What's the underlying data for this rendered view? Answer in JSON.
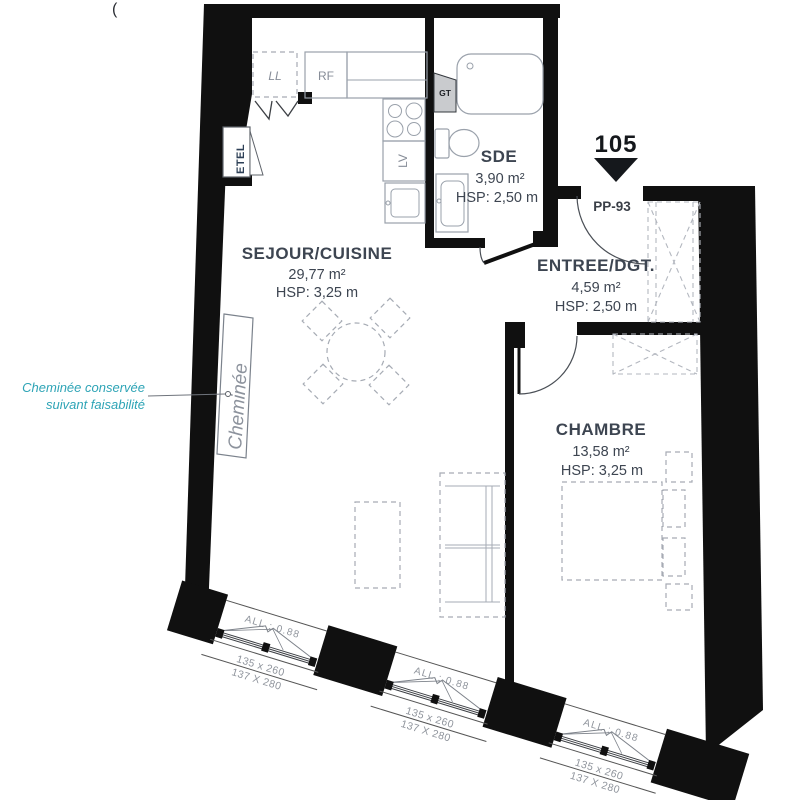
{
  "meta": {
    "stray_mark": "("
  },
  "unit": {
    "number": "105",
    "entry_door_label": "PP-93"
  },
  "rooms": {
    "sejour": {
      "name": "SEJOUR/CUISINE",
      "area": "29,77 m²",
      "hsp": "HSP: 3,25 m"
    },
    "sde": {
      "name": "SDE",
      "area": "3,90 m²",
      "hsp": "HSP: 2,50 m"
    },
    "entree": {
      "name": "ENTREE/DGT.",
      "area": "4,59 m²",
      "hsp": "HSP: 2,50 m"
    },
    "chambre": {
      "name": "CHAMBRE",
      "area": "13,58 m²",
      "hsp": "HSP: 3,25 m"
    }
  },
  "fixtures": {
    "ll": "LL",
    "rf": "RF",
    "lv": "LV",
    "gt": "GT",
    "etel": "ETEL"
  },
  "fireplace": {
    "label": "Cheminée",
    "note_line1": "Cheminée conservée",
    "note_line2": "suivant faisabilité"
  },
  "windows": [
    {
      "allege": "ALL : 0.88",
      "dim1": "135 x 260",
      "dim2": "137 X 280"
    },
    {
      "allege": "ALL : 0.88",
      "dim1": "135 x 260",
      "dim2": "137 X 280"
    },
    {
      "allege": "ALL : 0.88",
      "dim1": "135 x 260",
      "dim2": "137 X 280"
    }
  ],
  "colors": {
    "wall": "#101010",
    "room_text": "#3d4551",
    "annotation_teal": "#2ea4b6",
    "fixture_gray": "#9aa1ab",
    "label_gray": "#878d98"
  }
}
